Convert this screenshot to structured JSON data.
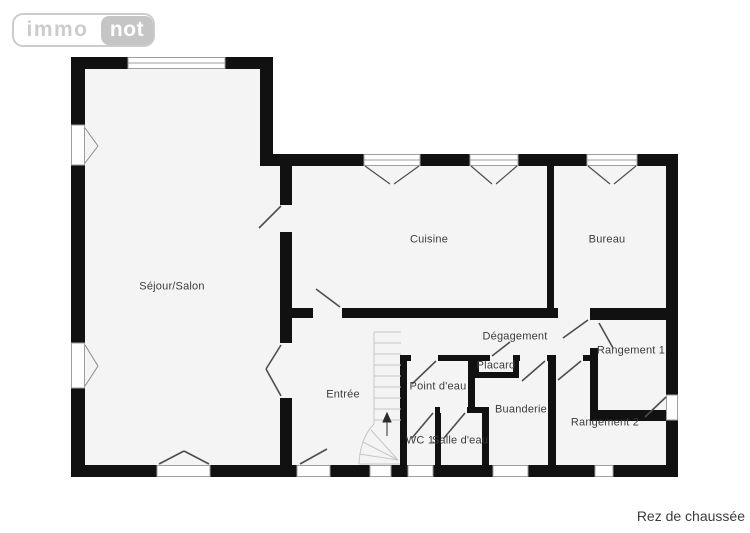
{
  "watermark_logo": {
    "part1": "immo",
    "part2": "not"
  },
  "caption": "Rez de chaussée",
  "rooms": [
    {
      "id": "sejour-salon",
      "label": "Séjour/Salon"
    },
    {
      "id": "cuisine",
      "label": "Cuisine"
    },
    {
      "id": "bureau",
      "label": "Bureau"
    },
    {
      "id": "degagement",
      "label": "Dégagement"
    },
    {
      "id": "rangement-1",
      "label": "Rangement 1"
    },
    {
      "id": "entree",
      "label": "Entrée"
    },
    {
      "id": "point-deau",
      "label": "Point d'eau"
    },
    {
      "id": "placard",
      "label": "Placard"
    },
    {
      "id": "buanderie",
      "label": "Buanderie"
    },
    {
      "id": "wc-1",
      "label": "WC 1"
    },
    {
      "id": "salle-deau",
      "label": "Salle d'eau"
    },
    {
      "id": "rangement-2",
      "label": "Rangement 2"
    }
  ],
  "icons": {
    "window-icon": "white gap in wall with thin gray frame lines",
    "casement-window-icon": "V-shaped opening strokes inside room",
    "door-swing-icon": "diagonal leaf stroke",
    "staircase-icon": "gray treads with winder fan",
    "stairs-up-arrow-icon": "arrow pointing up the flight"
  },
  "colors": {
    "wall": "#111111",
    "floor": "#f4f4f4",
    "label_text": "#3c3c3c",
    "door_line": "#4d4d4d",
    "window_line": "#9e9e9e",
    "stairs_line": "#c6c6c6",
    "logo_gray": "#cccccc",
    "background": "#ffffff"
  }
}
